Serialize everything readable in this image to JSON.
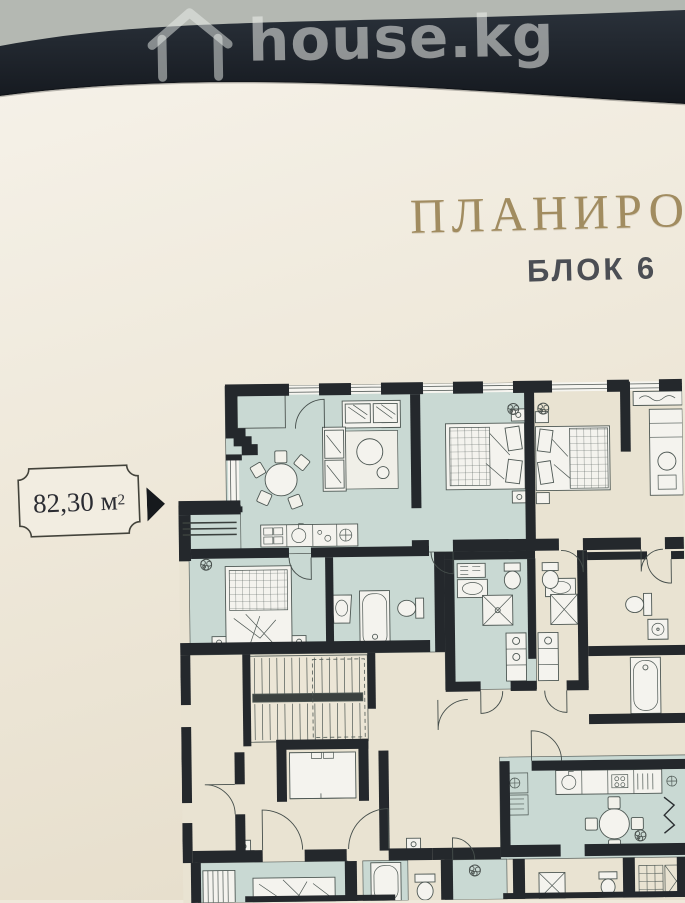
{
  "watermark": {
    "brand": "house.kg"
  },
  "document": {
    "title_visible": "ПЛАНИРОВ",
    "subtitle": "БЛОК 6",
    "area_plaque": {
      "value": "82,30",
      "unit": "м",
      "sup": "2"
    }
  },
  "floor_plan": {
    "highlighted_area_m2": "82,30",
    "block": "6"
  },
  "colors": {
    "surface_gray": "#b4b8b2",
    "band_dark": "#1e242b",
    "paper": "#efe9db",
    "title_gold": "#a18c60",
    "subtitle_dark": "#4b4e54",
    "wall": "#24282c",
    "room_highlight": "#c9d9d3",
    "room_neutral": "#e9e3d2"
  }
}
